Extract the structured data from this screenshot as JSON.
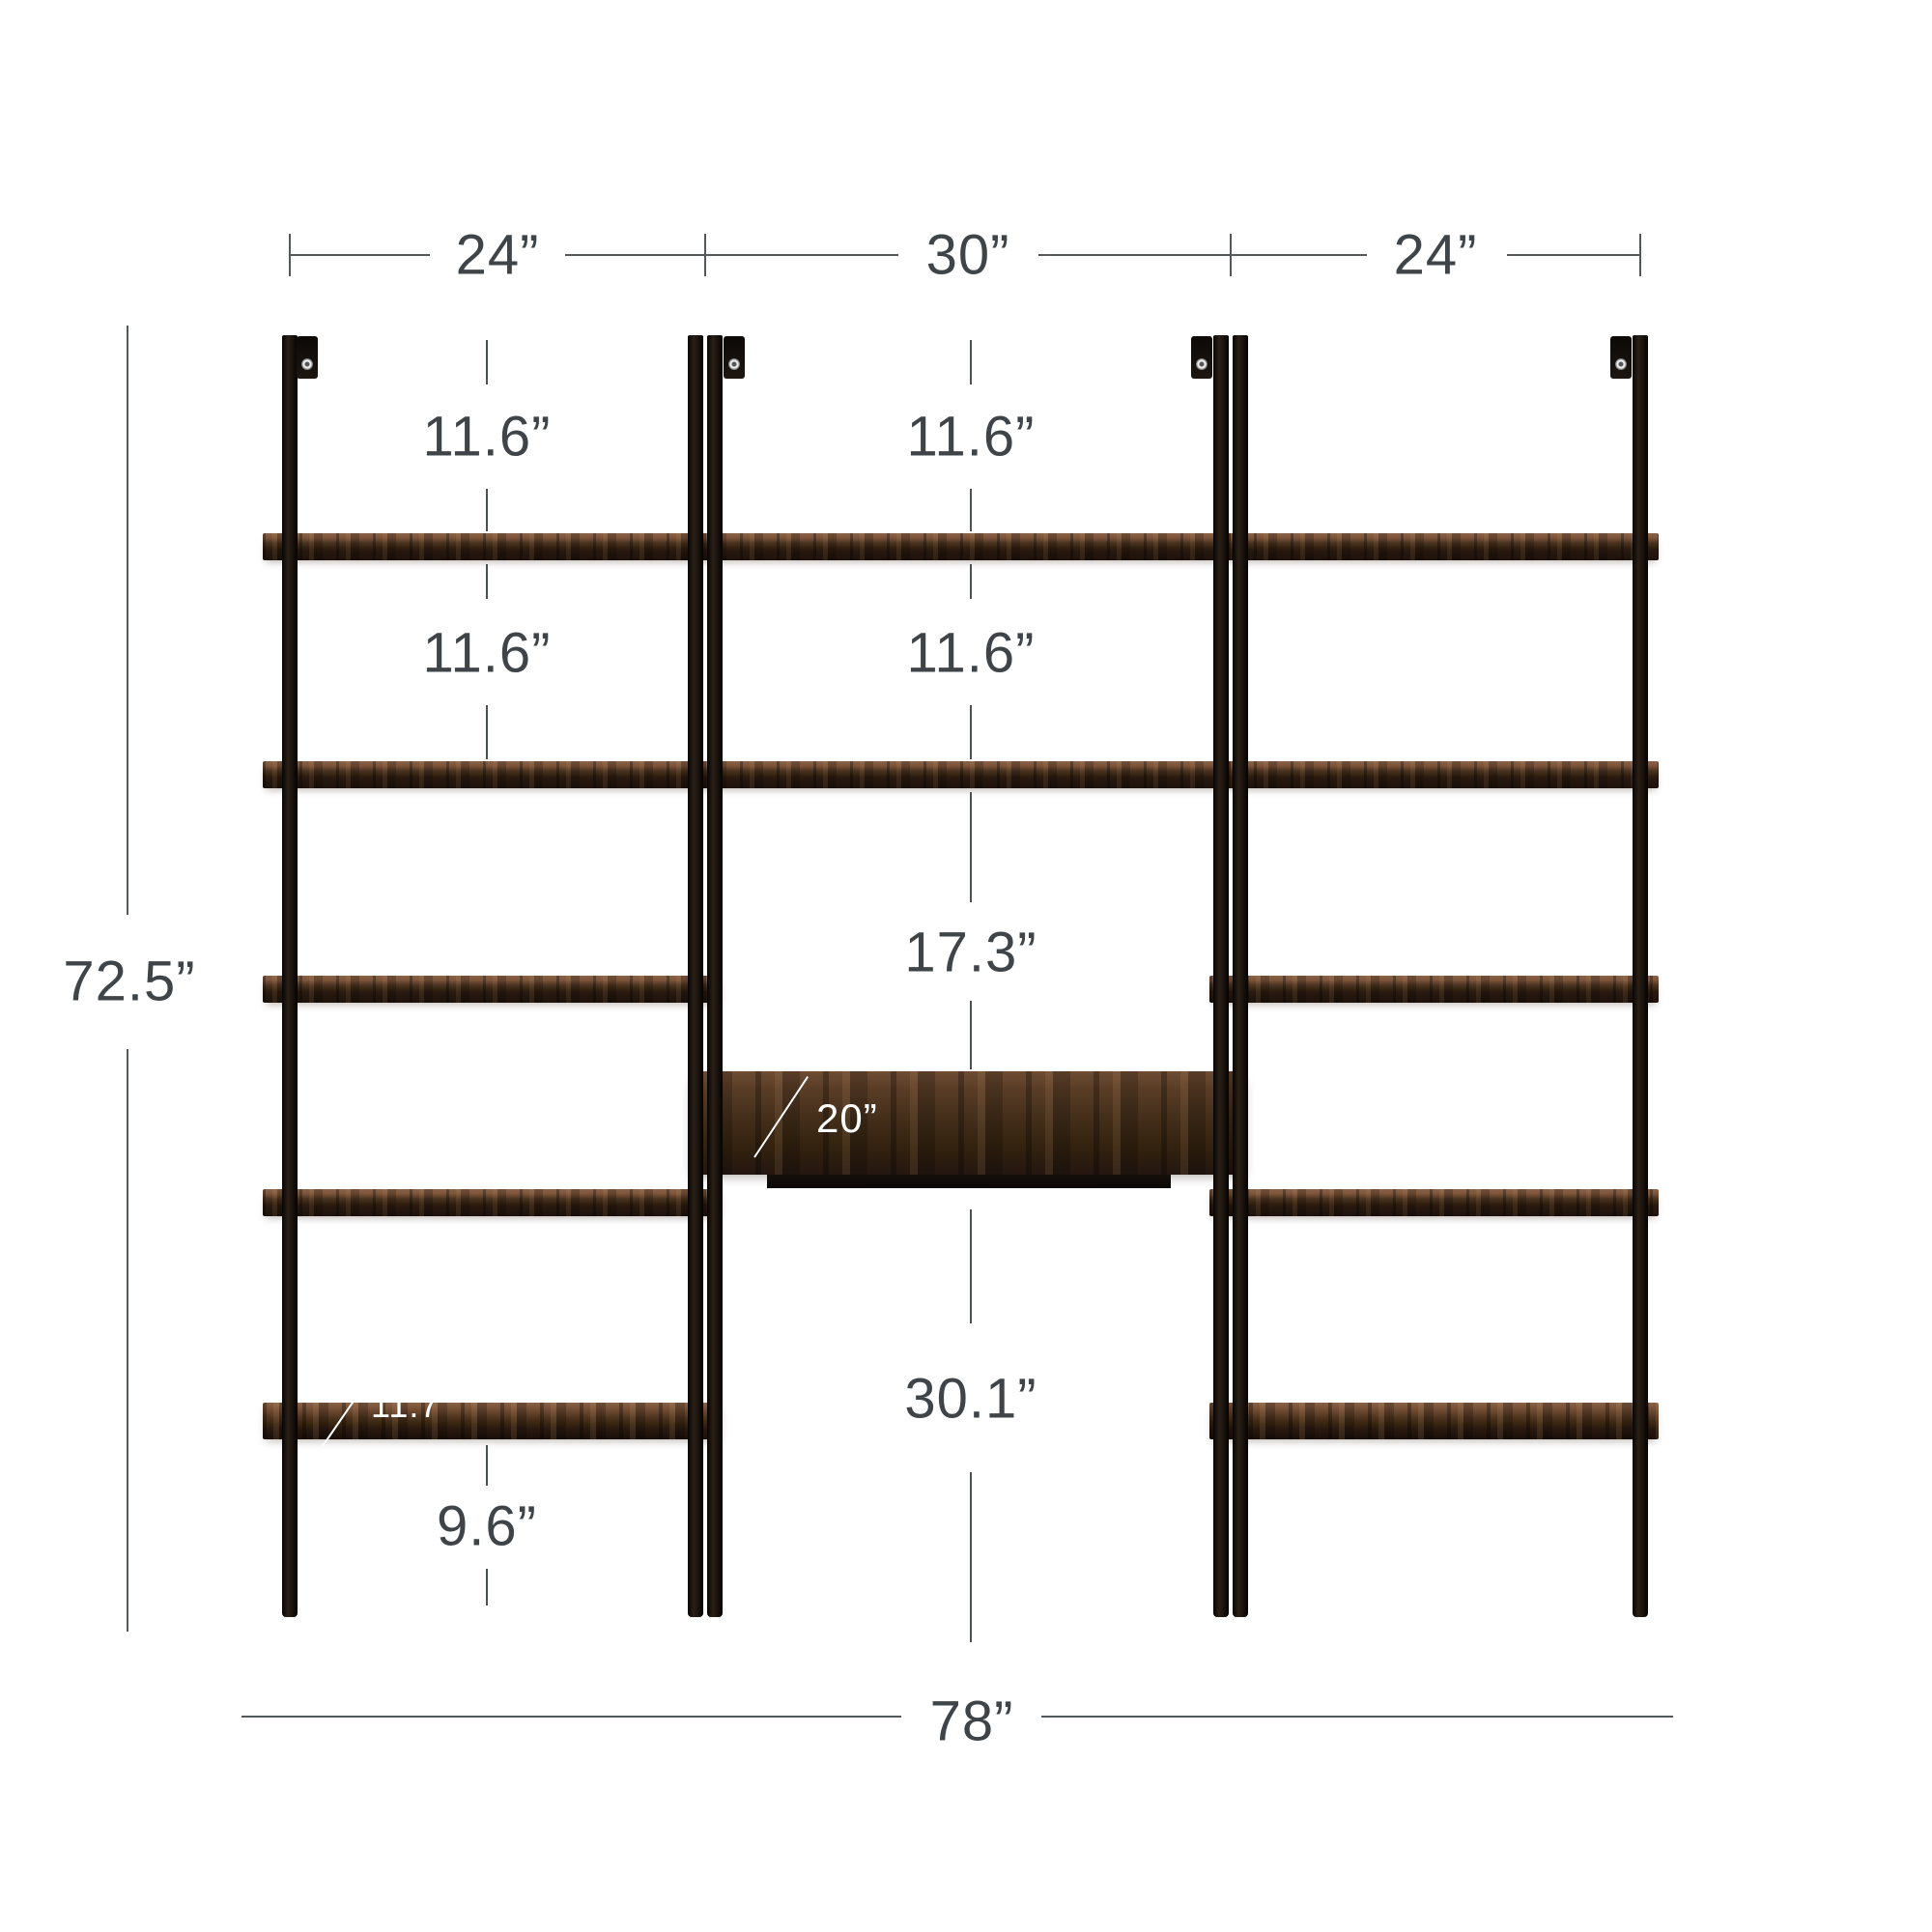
{
  "diagram": {
    "subject": "three-piece wall-mounted ladder shelf with desk, dimension drawing",
    "unit_widths": {
      "left": "24”",
      "middle": "30”",
      "right": "24”"
    },
    "overall": {
      "width": "78”",
      "height": "72.5”"
    },
    "gaps": {
      "left_bay": [
        "11.6”",
        "11.6”"
      ],
      "middle_bay": [
        "11.6”",
        "11.6”"
      ],
      "desk_clearance": "17.3”",
      "below_desk": "30.1”",
      "below_bottom_shelf": "9.6”"
    },
    "depths": {
      "shelf": "11.7”",
      "desk": "20”"
    },
    "colors": {
      "background": "#ffffff",
      "metal": "#1a1410",
      "wood_dark": "#2b1c12",
      "wood_light": "#8a6347",
      "dim_text": "#3f4449",
      "dim_line": "#53585b",
      "callout_text": "#ffffff"
    }
  }
}
